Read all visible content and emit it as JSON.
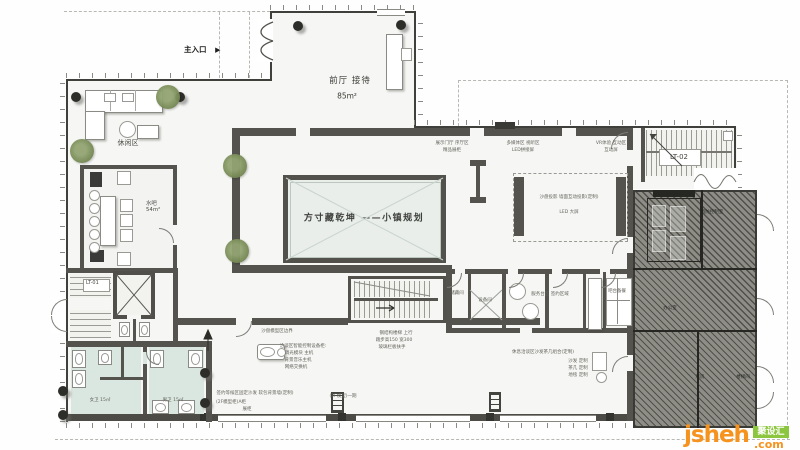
{
  "labels": {
    "entrance": "主入口",
    "entrance_arrow": "▶",
    "front_hall": "前厅  接待",
    "front_hall_area": "85m²",
    "leisure": "休闲区",
    "bar_room": "水吧",
    "bar_room_area": "54m²",
    "model_caption": "方寸藏乾坤 ——小镇规划",
    "stair_1": "LT-01",
    "stair_2": "LT-02"
  },
  "watermark": {
    "brand": "jsheh",
    "tld": ".com",
    "badge": "聚设汇",
    "brand_color": "#f6921e",
    "badge_color": "#8cc63e"
  },
  "colors": {
    "wall_dark": "#55534e",
    "wall_line": "#3f3f3b",
    "model_room_fill": "#e9eeea",
    "washroom_floor": "#dae7e0",
    "hatch_gray": "#8e8e87",
    "tree_green": "#7a8d58"
  },
  "annotations": [
    {
      "t": "展示门厅 序厅区",
      "x": 452,
      "y": 143
    },
    {
      "t": "精品展柜",
      "x": 452,
      "y": 150
    },
    {
      "t": "多媒体区 视听区",
      "x": 523,
      "y": 143
    },
    {
      "t": "LED拼接屏",
      "x": 523,
      "y": 150
    },
    {
      "t": "VR体验 互动区",
      "x": 611,
      "y": 143
    },
    {
      "t": "互动屏",
      "x": 611,
      "y": 150
    },
    {
      "t": "沙盘投影 墙面互动投影(定制)",
      "x": 569,
      "y": 197
    },
    {
      "t": "LED 大屏",
      "x": 569,
      "y": 212
    },
    {
      "t": "钢结构楼梯 上行",
      "x": 396,
      "y": 333
    },
    {
      "t": "踏步高150 宽300",
      "x": 394,
      "y": 340
    },
    {
      "t": "玻璃栏板扶手",
      "x": 392,
      "y": 347
    },
    {
      "t": "洽谈区智能控制设备柜:",
      "x": 303,
      "y": 346
    },
    {
      "t": "调光模块 主机",
      "x": 299,
      "y": 353
    },
    {
      "t": "背景音乐主机",
      "x": 298,
      "y": 360
    },
    {
      "t": "网络交换机",
      "x": 296,
      "y": 367
    },
    {
      "t": "签约等候区固定沙发 软包背景墙(定制)",
      "x": 255,
      "y": 393
    },
    {
      "t": "(2F模型柜)A柜",
      "x": 231,
      "y": 402
    },
    {
      "t": "展柜",
      "x": 247,
      "y": 409
    },
    {
      "t": "(2F模型)一期",
      "x": 343,
      "y": 396
    },
    {
      "t": "休息洽谈区沙发茶几组合(定制)",
      "x": 543,
      "y": 352
    },
    {
      "t": "沙发 定制",
      "x": 578,
      "y": 361
    },
    {
      "t": "茶几 定制",
      "x": 578,
      "y": 368
    },
    {
      "t": "地毯 定制",
      "x": 578,
      "y": 375
    },
    {
      "t": "服务台区 签约区域",
      "x": 550,
      "y": 294
    },
    {
      "t": "储藏间",
      "x": 457,
      "y": 293
    },
    {
      "t": "设备间",
      "x": 485,
      "y": 300
    },
    {
      "t": "吧台备餐",
      "x": 617,
      "y": 291
    },
    {
      "t": "消防控制室",
      "x": 712,
      "y": 212,
      "light": true
    },
    {
      "t": "办公室",
      "x": 670,
      "y": 308,
      "light": true
    },
    {
      "t": "库房",
      "x": 700,
      "y": 377,
      "light": true
    },
    {
      "t": "楼梯间",
      "x": 743,
      "y": 377,
      "light": true
    },
    {
      "t": "女卫 15㎡",
      "x": 100,
      "y": 400
    },
    {
      "t": "男卫 15㎡",
      "x": 173,
      "y": 400
    },
    {
      "t": "沙盘模型区边界",
      "x": 277,
      "y": 331
    }
  ]
}
